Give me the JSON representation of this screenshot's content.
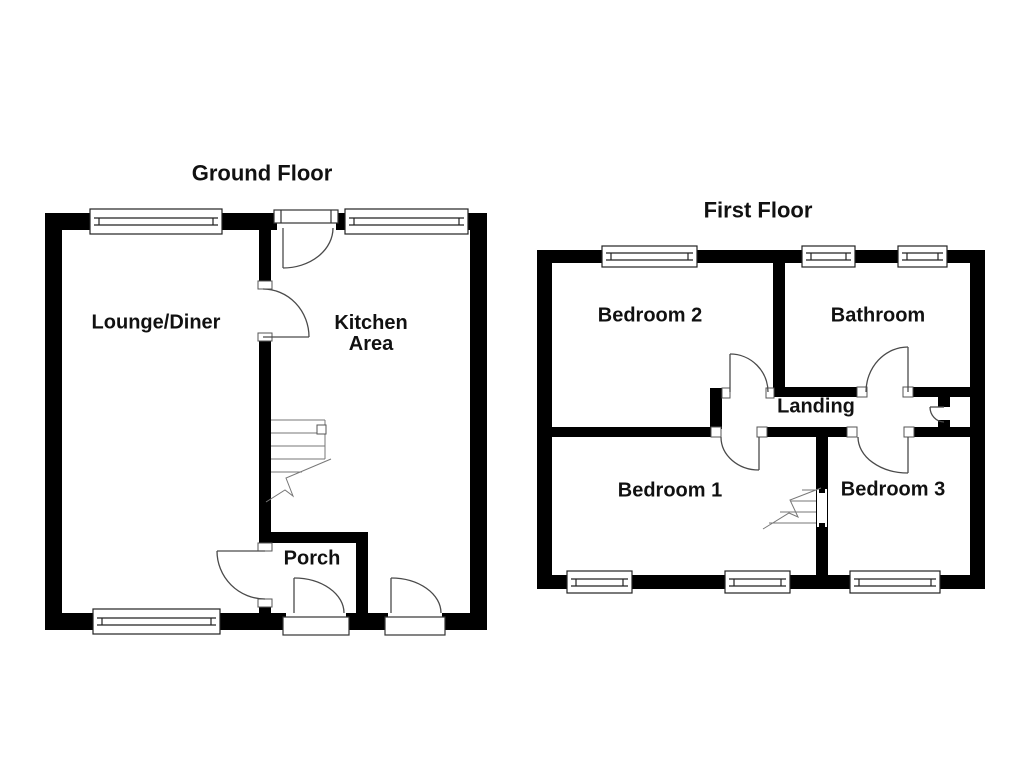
{
  "document": {
    "type": "floorplan",
    "colors": {
      "wall": "#000000",
      "background": "#ffffff",
      "door_line": "#4a4a4a",
      "stair_line": "#777777"
    }
  },
  "floors": [
    {
      "title": "Ground Floor",
      "rooms": [
        {
          "label": "Lounge/Diner"
        },
        {
          "label": "Kitchen Area"
        },
        {
          "label": "Porch"
        }
      ]
    },
    {
      "title": "First Floor",
      "rooms": [
        {
          "label": "Bedroom 2"
        },
        {
          "label": "Bathroom"
        },
        {
          "label": "Landing"
        },
        {
          "label": "Bedroom 1"
        },
        {
          "label": "Bedroom 3"
        }
      ]
    }
  ]
}
